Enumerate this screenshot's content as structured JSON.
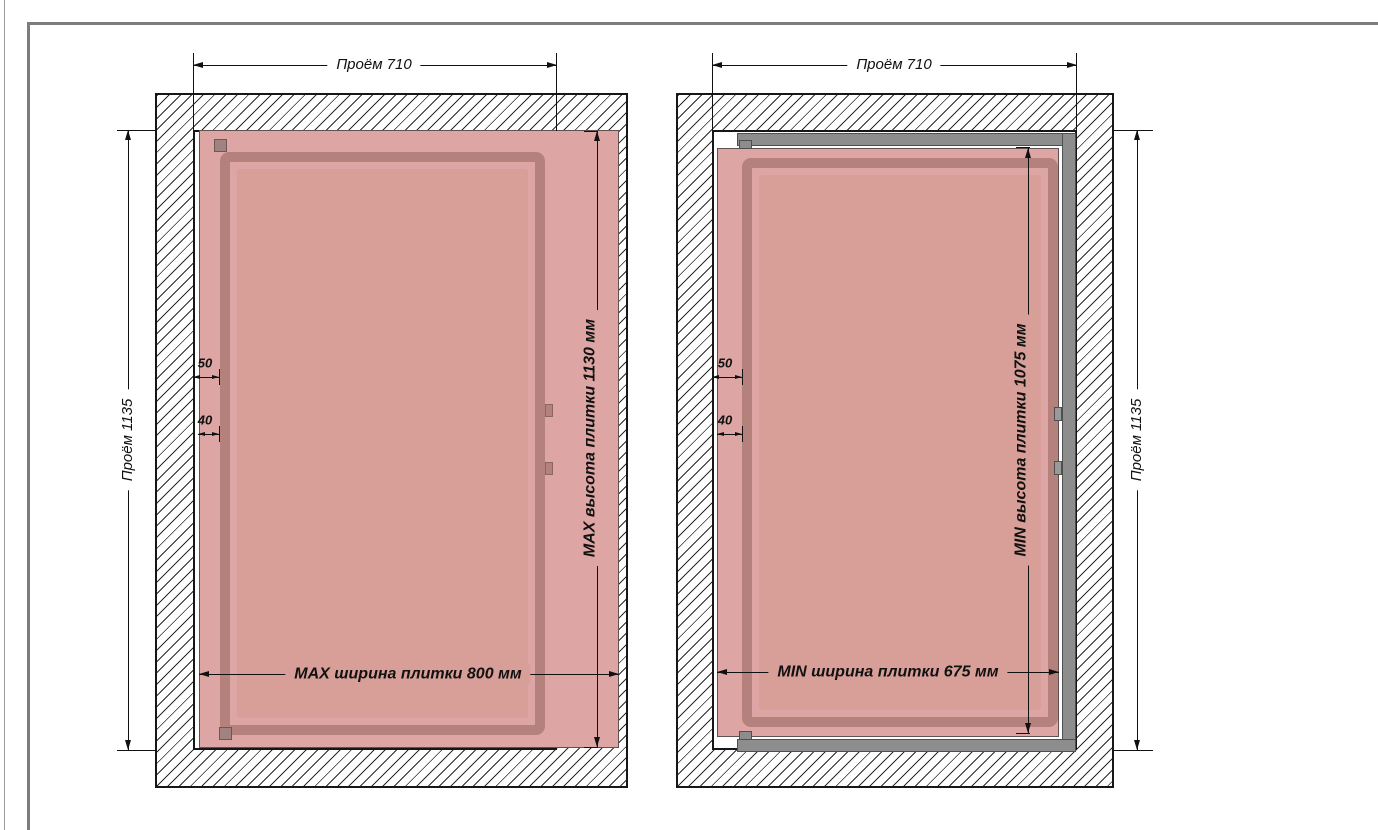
{
  "document": {
    "type": "technical-installation-drawing",
    "language": "ru",
    "subject": "hidden-access-hatch-tile-size-limits"
  },
  "colors": {
    "tile": "#dda6a4",
    "inner_panel": "#d89f98",
    "door_profile": "#b4817d",
    "metal_frame_gray": "#8d8d8d",
    "drawing_line": "#111111",
    "sheet_frame": "#7d7d7d"
  },
  "drawings": {
    "left": {
      "name": "max-tile-size-view",
      "opening_width_label": "Проём 710",
      "opening_height_label": "Проём 1135",
      "tile_width_label": "MAX ширина плитки 800 мм",
      "tile_height_label": "MAX высота плитки 1130 мм",
      "gap_frame_label": "50",
      "gap_tile_label": "40"
    },
    "right": {
      "name": "min-tile-size-view",
      "opening_width_label": "Проём 710",
      "opening_height_label": "Проём 1135",
      "tile_width_label": "MIN ширина плитки 675 мм",
      "tile_height_label": "MIN высота плитки 1075 мм",
      "gap_frame_label": "50",
      "gap_tile_label": "40"
    }
  }
}
